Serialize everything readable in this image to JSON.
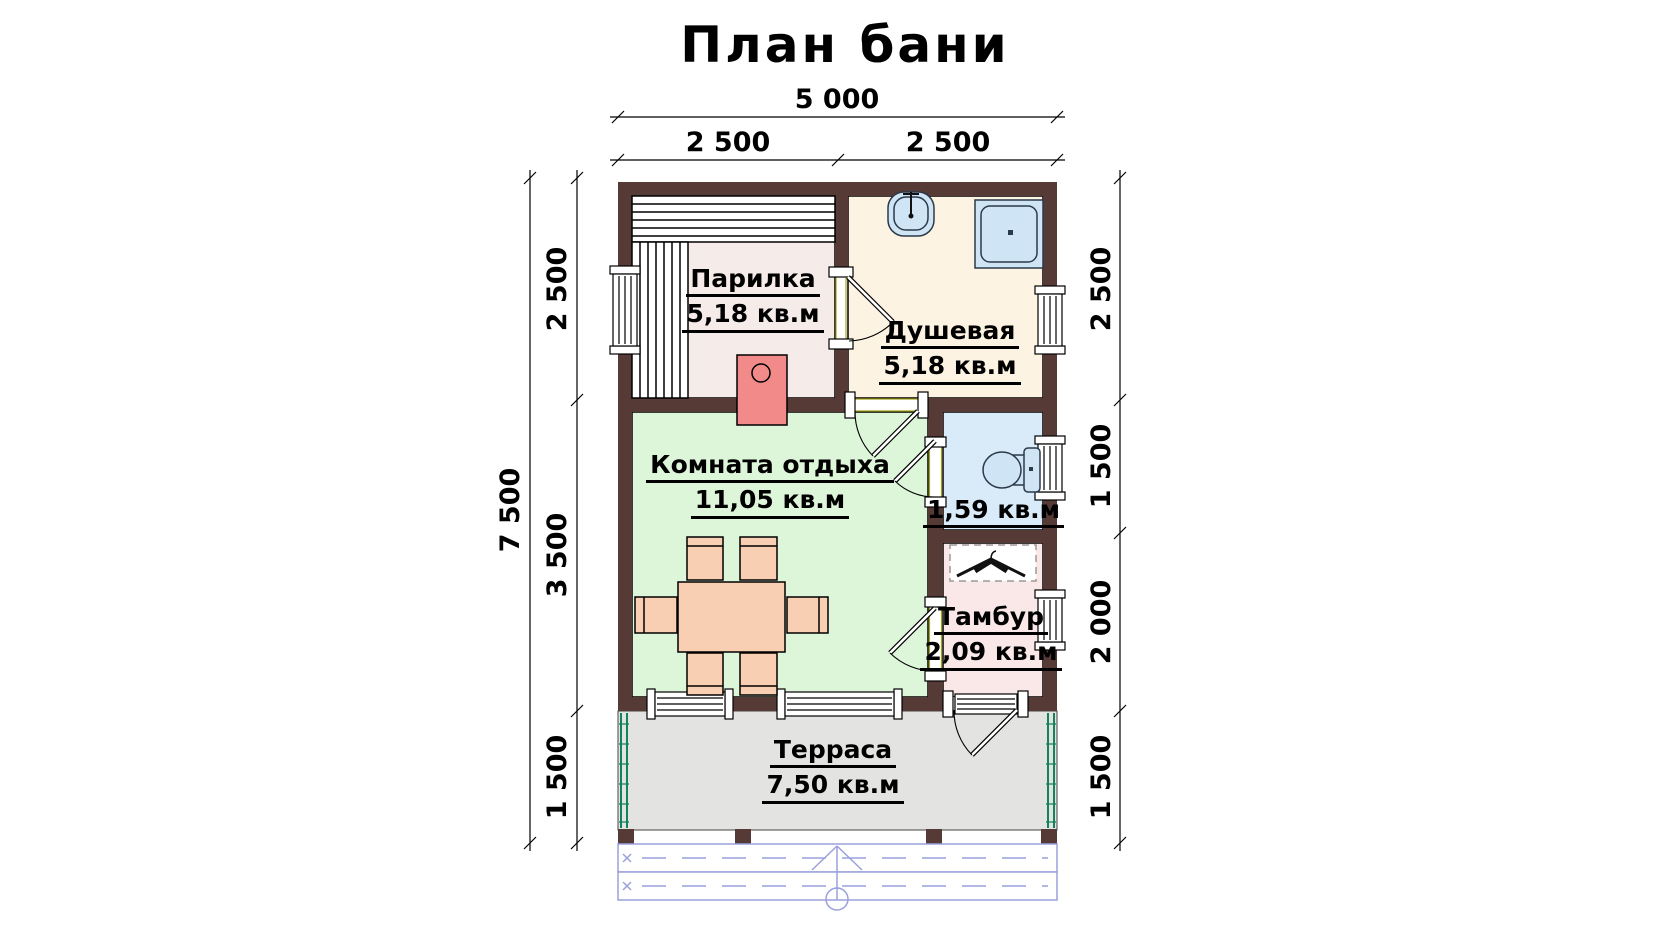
{
  "title": "План бани",
  "rooms": {
    "parilka": {
      "name": "Парилка",
      "area": "5,18 кв.м"
    },
    "dushevaya": {
      "name": "Душевая",
      "area": "5,18 кв.м"
    },
    "lounge": {
      "name": "Комната отдыха",
      "area": "11,05 кв.м"
    },
    "toilet": {
      "area": "1,59 кв.м"
    },
    "tambour": {
      "name": "Тамбур",
      "area": "2,09 кв.м"
    },
    "terrace": {
      "name": "Терраса",
      "area": "7,50 кв.м"
    }
  },
  "dimensions": {
    "top_total": "5 000",
    "top_segments": [
      "2 500",
      "2 500"
    ],
    "left_total": "7 500",
    "left_segments": [
      "2 500",
      "3 500",
      "1 500"
    ],
    "right_segments": [
      "2 500",
      "1 500",
      "2 000",
      "1 500"
    ]
  },
  "fixtures": [
    "sauna-benches",
    "stove",
    "sink",
    "shower-tray",
    "toilet",
    "coat-hanger",
    "dining-table-with-chairs",
    "entrance-steps-arrow"
  ],
  "colors": {
    "wall": "#553a36",
    "parilka_floor": "#f5ebe9",
    "shower_floor": "#fdf3e2",
    "lounge_floor": "#ddf5d9",
    "toilet_floor": "#d9eaf8",
    "tambour_floor": "#f9e8e7",
    "terrace_floor": "#e3e3e1",
    "stove": "#f28a8a",
    "furniture": "#f8cfb2",
    "fixture": "#cfe5f6",
    "steps": "#9aa0dc",
    "railing": "#12835e"
  }
}
